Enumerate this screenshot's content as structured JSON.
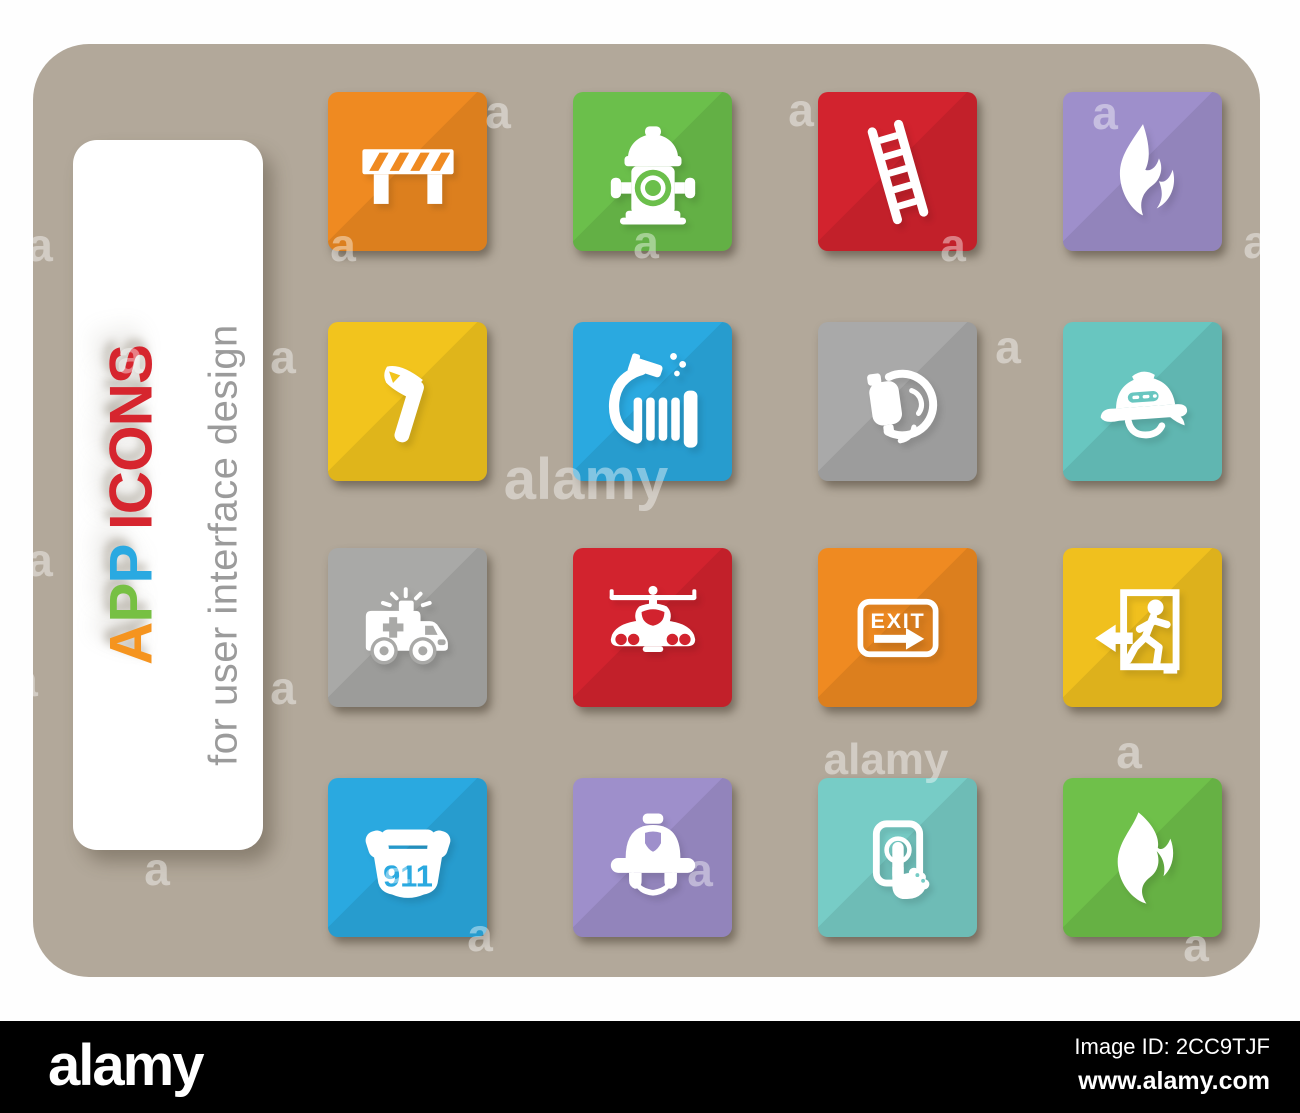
{
  "label_card": {
    "title_text": "APP ICONS",
    "title_letters": [
      {
        "ch": "A",
        "color": "#f5941f"
      },
      {
        "ch": "P",
        "color": "#77c043"
      },
      {
        "ch": "P",
        "color": "#2aa9e1"
      },
      {
        "ch": " ",
        "color": "#d6252e"
      },
      {
        "ch": "I",
        "color": "#d6252e"
      },
      {
        "ch": "C",
        "color": "#d6252e"
      },
      {
        "ch": "O",
        "color": "#d6252e"
      },
      {
        "ch": "N",
        "color": "#d6252e"
      },
      {
        "ch": "S",
        "color": "#d6252e"
      }
    ],
    "subtitle": "for user interface design",
    "subtitle_color": "#9b9b9b"
  },
  "canvas_color": "#b2a89a",
  "icons": [
    {
      "name": "road-barrier",
      "glyph": "barrier",
      "color": "#ef8a21",
      "label": ""
    },
    {
      "name": "fire-hydrant",
      "glyph": "hydrant",
      "color": "#6bbf4b",
      "label": ""
    },
    {
      "name": "fire-ladder",
      "glyph": "ladder",
      "color": "#d2232e",
      "label": ""
    },
    {
      "name": "flame",
      "glyph": "flame1",
      "color": "#9e8fcb",
      "label": ""
    },
    {
      "name": "fire-axe",
      "glyph": "axe",
      "color": "#f2c41d",
      "label": ""
    },
    {
      "name": "fire-hose",
      "glyph": "hose",
      "color": "#2aa9e0",
      "label": ""
    },
    {
      "name": "breathing-mask",
      "glyph": "mask",
      "color": "#a9a9a9",
      "label": ""
    },
    {
      "name": "fire-helmet-side",
      "glyph": "helmetside",
      "color": "#68c6c0",
      "label": ""
    },
    {
      "name": "ambulance",
      "glyph": "ambulance",
      "color": "#a9a9a7",
      "label": ""
    },
    {
      "name": "fire-helicopter",
      "glyph": "helicopter",
      "color": "#d2232e",
      "label": ""
    },
    {
      "name": "exit-sign",
      "glyph": "exitsign",
      "color": "#ef8a21",
      "label": "EXIT"
    },
    {
      "name": "emergency-exit",
      "glyph": "exitdoor",
      "color": "#f0c01e",
      "label": ""
    },
    {
      "name": "phone-911",
      "glyph": "phone911",
      "color": "#2aa9e0",
      "label": "911"
    },
    {
      "name": "fire-helmet-front",
      "glyph": "helmetfront",
      "color": "#9e8fcb",
      "label": ""
    },
    {
      "name": "alarm-button",
      "glyph": "alarmbutton",
      "color": "#77ccc6",
      "label": ""
    },
    {
      "name": "bonfire",
      "glyph": "flame2",
      "color": "#6fc04a",
      "label": ""
    }
  ],
  "watermarks": [
    {
      "text": "a",
      "x": 498,
      "y": 112,
      "size": 46
    },
    {
      "text": "a",
      "x": 801,
      "y": 110,
      "size": 46
    },
    {
      "text": "a",
      "x": 1105,
      "y": 113,
      "size": 46
    },
    {
      "text": "a",
      "x": 40,
      "y": 245,
      "size": 46
    },
    {
      "text": "a",
      "x": 343,
      "y": 245,
      "size": 46
    },
    {
      "text": "a",
      "x": 646,
      "y": 242,
      "size": 46
    },
    {
      "text": "a",
      "x": 953,
      "y": 245,
      "size": 46
    },
    {
      "text": "a",
      "x": 1256,
      "y": 242,
      "size": 46
    },
    {
      "text": "a",
      "x": 130,
      "y": 357,
      "size": 46
    },
    {
      "text": "a",
      "x": 283,
      "y": 357,
      "size": 46
    },
    {
      "text": "a",
      "x": 1008,
      "y": 347,
      "size": 46
    },
    {
      "text": "alamy",
      "x": 586,
      "y": 480,
      "size": 58
    },
    {
      "text": "a",
      "x": 40,
      "y": 560,
      "size": 46
    },
    {
      "text": "a",
      "x": 1129,
      "y": 752,
      "size": 46
    },
    {
      "text": "a",
      "x": 25,
      "y": 680,
      "size": 46
    },
    {
      "text": "a",
      "x": 283,
      "y": 688,
      "size": 46
    },
    {
      "text": "alamy",
      "x": 886,
      "y": 760,
      "size": 44
    },
    {
      "text": "a",
      "x": 157,
      "y": 869,
      "size": 46
    },
    {
      "text": "a",
      "x": 397,
      "y": 867,
      "size": 46
    },
    {
      "text": "a",
      "x": 700,
      "y": 870,
      "size": 46
    },
    {
      "text": "a",
      "x": 480,
      "y": 935,
      "size": 46
    },
    {
      "text": "a",
      "x": 1196,
      "y": 945,
      "size": 46
    }
  ],
  "footer": {
    "logo": "alamy",
    "image_id_label": "Image ID: 2CC9TJF",
    "url": "www.alamy.com"
  }
}
